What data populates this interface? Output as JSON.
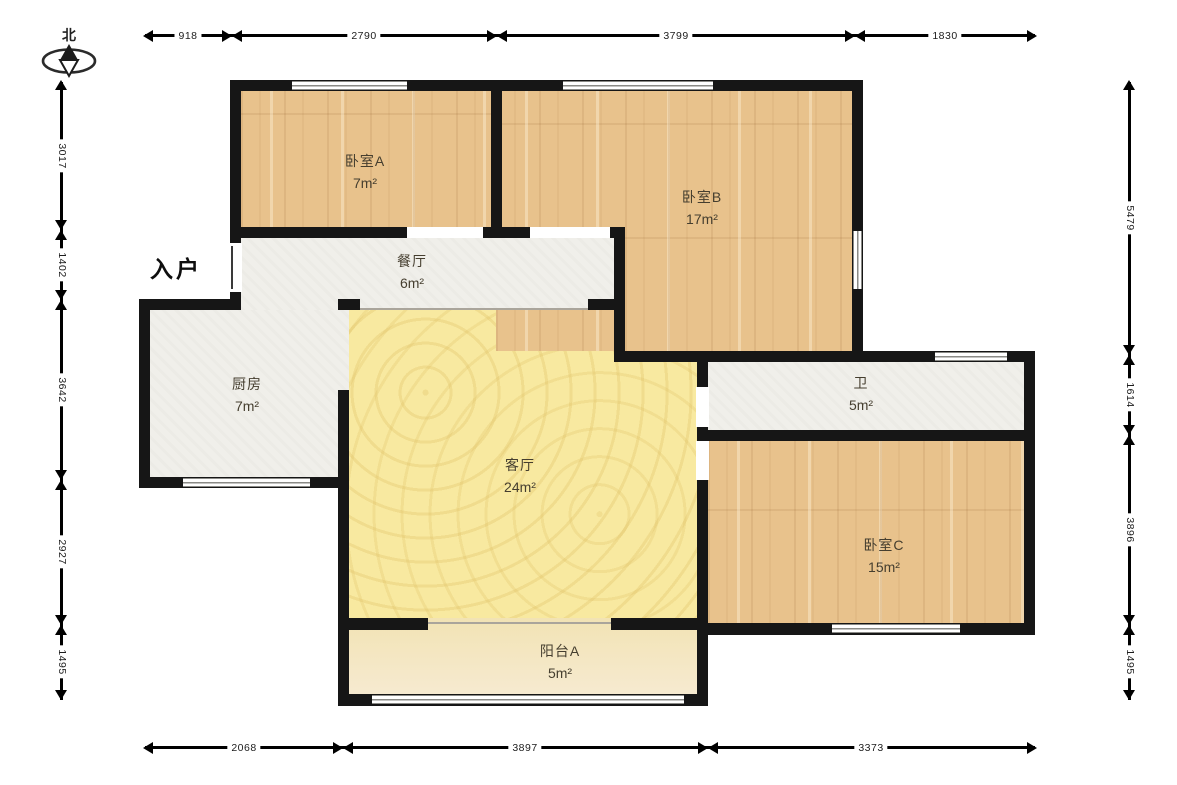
{
  "compass": {
    "north_label": "北"
  },
  "entrance": {
    "label": "入户"
  },
  "rooms": [
    {
      "name": "卧室A",
      "area": "7m²"
    },
    {
      "name": "卧室B",
      "area": "17m²"
    },
    {
      "name": "餐厅",
      "area": "6m²"
    },
    {
      "name": "厨房",
      "area": "7m²"
    },
    {
      "name": "客厅",
      "area": "24m²"
    },
    {
      "name": "卫",
      "area": "5m²"
    },
    {
      "name": "卧室C",
      "area": "15m²"
    },
    {
      "name": "阳台A",
      "area": "5m²"
    }
  ],
  "dimensions_mm": {
    "top": [
      "918",
      "2790",
      "3799",
      "1830"
    ],
    "bottom": [
      "2068",
      "3897",
      "3373"
    ],
    "left": [
      "3017",
      "1402",
      "3642",
      "2927",
      "1495"
    ],
    "right": [
      "5479",
      "1614",
      "3896",
      "1495"
    ]
  },
  "colors": {
    "wall": "#161616",
    "wood_floor": "#e8c28c",
    "living_floor": "#f8e9a0",
    "balcony_floor": "#f4e6bc",
    "service_floor": "#f0efea",
    "window_line": "#8a8a86"
  }
}
